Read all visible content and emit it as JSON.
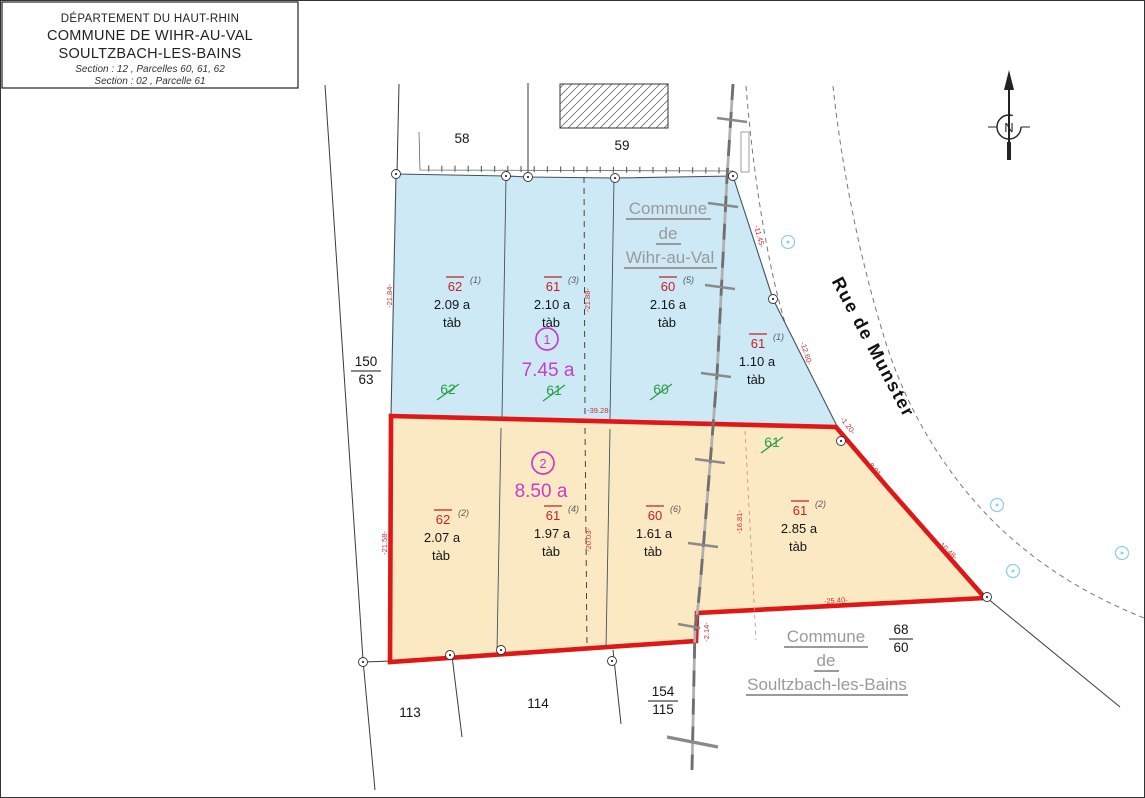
{
  "title_block": {
    "department": "DÉPARTEMENT DU HAUT-RHIN",
    "commune1": "COMMUNE DE WIHR-AU-VAL",
    "commune2": "SOULTZBACH-LES-BAINS",
    "section1": "Section : 12 , Parcelles 60, 61, 62",
    "section2": "Section : 02 , Parcelle 61"
  },
  "north_label": "N",
  "street_label": "Rue de Munster",
  "commune_labels": {
    "wihr": {
      "l1": "Commune",
      "l2": "de",
      "l3": "Wihr-au-Val"
    },
    "soultzbach": {
      "l1": "Commune",
      "l2": "de",
      "l3": "Soultzbach-les-Bains"
    }
  },
  "zones": {
    "z1": {
      "marker": "1",
      "area": "7.45 a"
    },
    "z2": {
      "marker": "2",
      "area": "8.50 a"
    }
  },
  "parcels": {
    "p62a": {
      "num": "62",
      "exp": "(1)",
      "area": "2.09 a",
      "note": "tàb"
    },
    "p61a": {
      "num": "61",
      "exp": "(3)",
      "area": "2.10 a",
      "note": "tàb"
    },
    "p60a": {
      "num": "60",
      "exp": "(5)",
      "area": "2.16 a",
      "note": "tàb"
    },
    "p61b": {
      "num": "61",
      "exp": "(1)",
      "area": "1.10 a",
      "note": "tàb"
    },
    "p62b": {
      "num": "62",
      "exp": "(2)",
      "area": "2.07 a",
      "note": "tàb"
    },
    "p61c": {
      "num": "61",
      "exp": "(4)",
      "area": "1.97 a",
      "note": "tàb"
    },
    "p60b": {
      "num": "60",
      "exp": "(6)",
      "area": "1.61 a",
      "note": "tàb"
    },
    "p61d": {
      "num": "61",
      "exp": "(2)",
      "area": "2.85 a",
      "note": "tàb"
    }
  },
  "old_numbers": {
    "o62": "62",
    "o61": "61",
    "o60": "60",
    "o61b": "61"
  },
  "adjacent": {
    "a58": "58",
    "a59": "59",
    "a113": "113",
    "a114": "114"
  },
  "fractions": {
    "f1": {
      "top": "150",
      "bot": "63"
    },
    "f2": {
      "top": "154",
      "bot": "115"
    },
    "f3": {
      "top": "68",
      "bot": "60"
    }
  },
  "measurements": {
    "m1": "-21.84-",
    "m2": "-21.88-",
    "m3": "-39.28-",
    "m4": "-21.58-",
    "m5": "-20.03-",
    "m6": "-16.81-",
    "m7": "-11.45-",
    "m8": "-12.60-",
    "m9": "-1.20-",
    "m10": "-8.91-",
    "m11": "-10.48-",
    "m12": "-25.40-",
    "m13": "-2.14-"
  },
  "colors": {
    "zone_wihr_fill": "#cde9f5",
    "zone_selection_fill": "#fbe9c4",
    "boundary_red": "#e01717",
    "commune_gray": "#9a9a9a",
    "old_number_green": "#2aa044",
    "zone_marker_magenta": "#c93cc9",
    "parcel_number_red": "#c32222",
    "measure_red": "#cc3333"
  }
}
